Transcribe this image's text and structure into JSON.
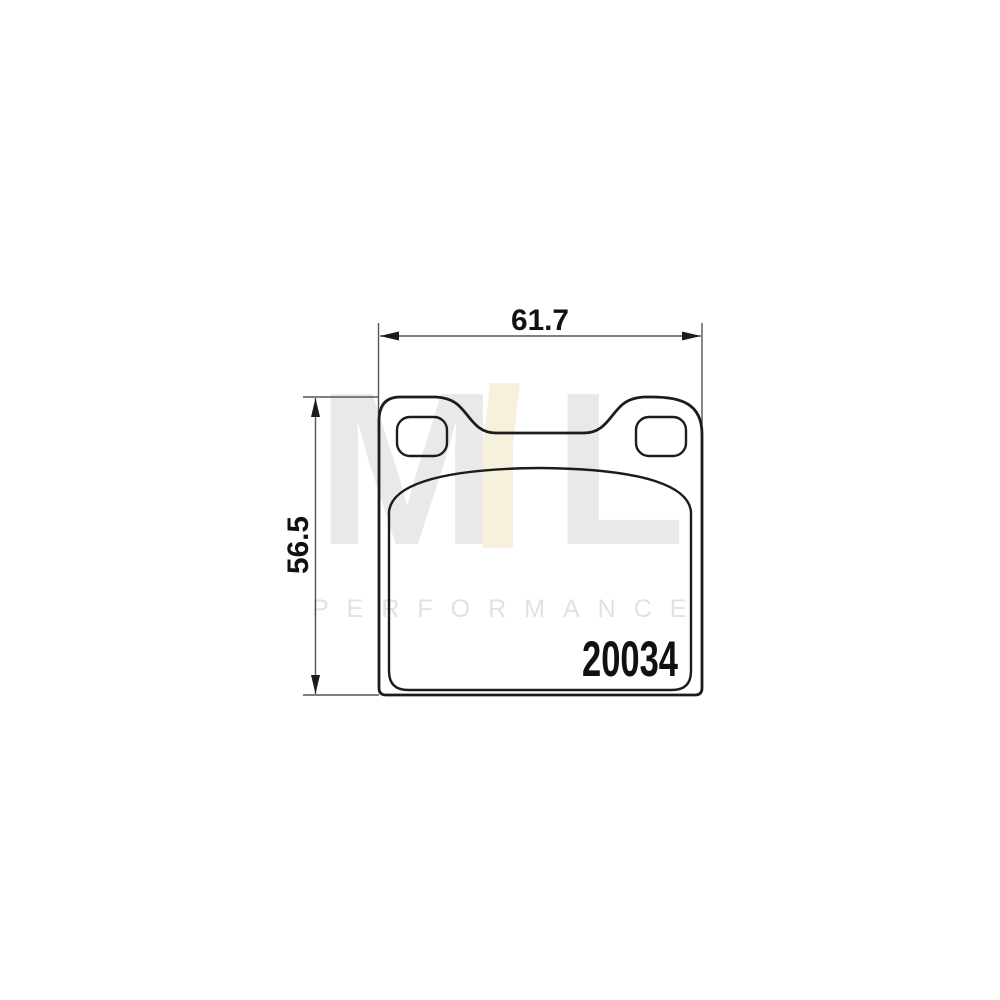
{
  "colors": {
    "background": "#ffffff",
    "outline": "#1c1c1c",
    "dimension_line": "#555555",
    "watermark_gray": "#e9e9e9",
    "watermark_cream": "#f6f0dd",
    "watermark_text": "#e2e2e2",
    "part_number_color": "#111111"
  },
  "dimensions": {
    "width_mm": "61.7",
    "height_mm": "56.5"
  },
  "part_number": "20034",
  "watermark": {
    "letter_m": "M",
    "letter_l": "L",
    "subtitle": "PERFORMANCE"
  }
}
